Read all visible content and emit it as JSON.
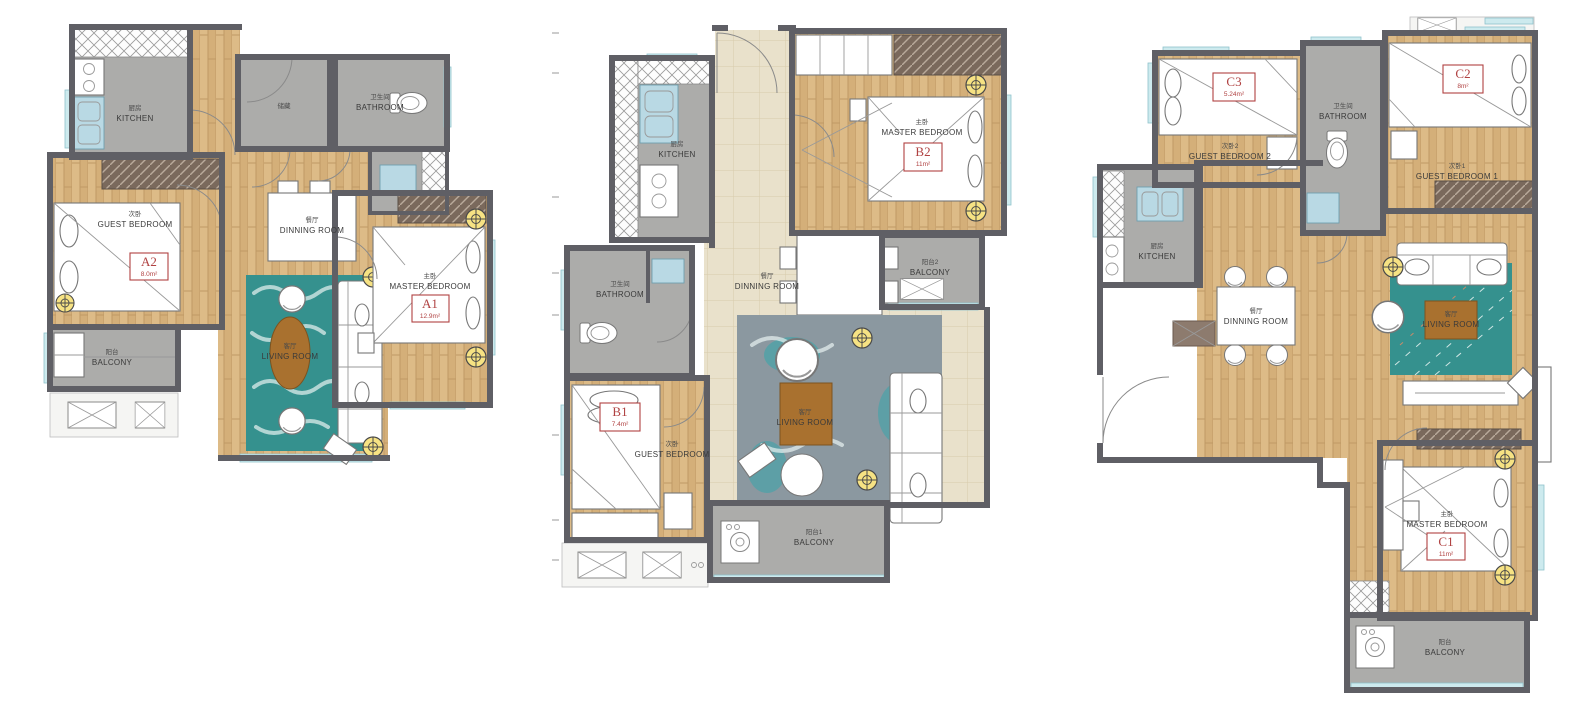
{
  "sheet": {
    "background": "#ffffff"
  },
  "colors": {
    "wall": "#5f5f65",
    "wood_floor": "#ddbb87",
    "tile_floor": "#acacaa",
    "marble_floor": "#e9e1cb",
    "window_glass": "#cdeaee",
    "rug_teal": "#35918e",
    "rug_gray": "#8b98a0",
    "label_red": "#b04242",
    "light_yellow": "#f6e283",
    "wardrobe_brown": "#7a695c",
    "table_wood": "#a9712f"
  },
  "plans": [
    {
      "name": "A",
      "rooms": {
        "kitchen": {
          "cn": "厨房",
          "en": "KITCHEN"
        },
        "storage": {
          "cn": "储藏",
          "en": ""
        },
        "bathroom": {
          "cn": "卫生间",
          "en": "BATHROOM"
        },
        "guest_bedroom": {
          "cn": "次卧",
          "en": "GUEST BEDROOM",
          "code": "A2",
          "area": "8.0m²"
        },
        "dinning_room": {
          "cn": "餐厅",
          "en": "DINNING ROOM"
        },
        "living_room": {
          "cn": "客厅",
          "en": "LIVING ROOM"
        },
        "master_bedroom": {
          "cn": "主卧",
          "en": "MASTER BEDROOM",
          "code": "A1",
          "area": "12.9m²"
        },
        "balcony": {
          "cn": "阳台",
          "en": "BALCONY"
        }
      }
    },
    {
      "name": "B",
      "rooms": {
        "kitchen": {
          "cn": "厨房",
          "en": "KITCHEN"
        },
        "master_bedroom": {
          "cn": "主卧",
          "en": "MASTER BEDROOM",
          "code": "B2",
          "area": "11m²"
        },
        "bathroom": {
          "cn": "卫生间",
          "en": "BATHROOM"
        },
        "dinning_room": {
          "cn": "餐厅",
          "en": "DINNING ROOM"
        },
        "balcony2": {
          "cn": "阳台2",
          "en": "BALCONY"
        },
        "guest_bedroom": {
          "cn": "次卧",
          "en": "GUEST BEDROOM",
          "code": "B1",
          "area": "7.4m²"
        },
        "living_room": {
          "cn": "客厅",
          "en": "LIVING ROOM"
        },
        "balcony1": {
          "cn": "阳台1",
          "en": "BALCONY"
        }
      }
    },
    {
      "name": "C",
      "rooms": {
        "guest_bedroom2": {
          "cn": "次卧2",
          "en": "GUEST BEDROOM 2",
          "code": "C3",
          "area": "5.24m²"
        },
        "bathroom": {
          "cn": "卫生间",
          "en": "BATHROOM"
        },
        "guest_bedroom1": {
          "cn": "次卧1",
          "en": "GUEST BEDROOM 1",
          "code": "C2",
          "area": "8m²"
        },
        "kitchen": {
          "cn": "厨房",
          "en": "KITCHEN"
        },
        "dinning_room": {
          "cn": "餐厅",
          "en": "DINNING ROOM"
        },
        "living_room": {
          "cn": "客厅",
          "en": "LIVING ROOM"
        },
        "master_bedroom": {
          "cn": "主卧",
          "en": "MASTER BEDROOM",
          "code": "C1",
          "area": "11m²"
        },
        "balcony": {
          "cn": "阳台",
          "en": "BALCONY"
        }
      }
    }
  ]
}
